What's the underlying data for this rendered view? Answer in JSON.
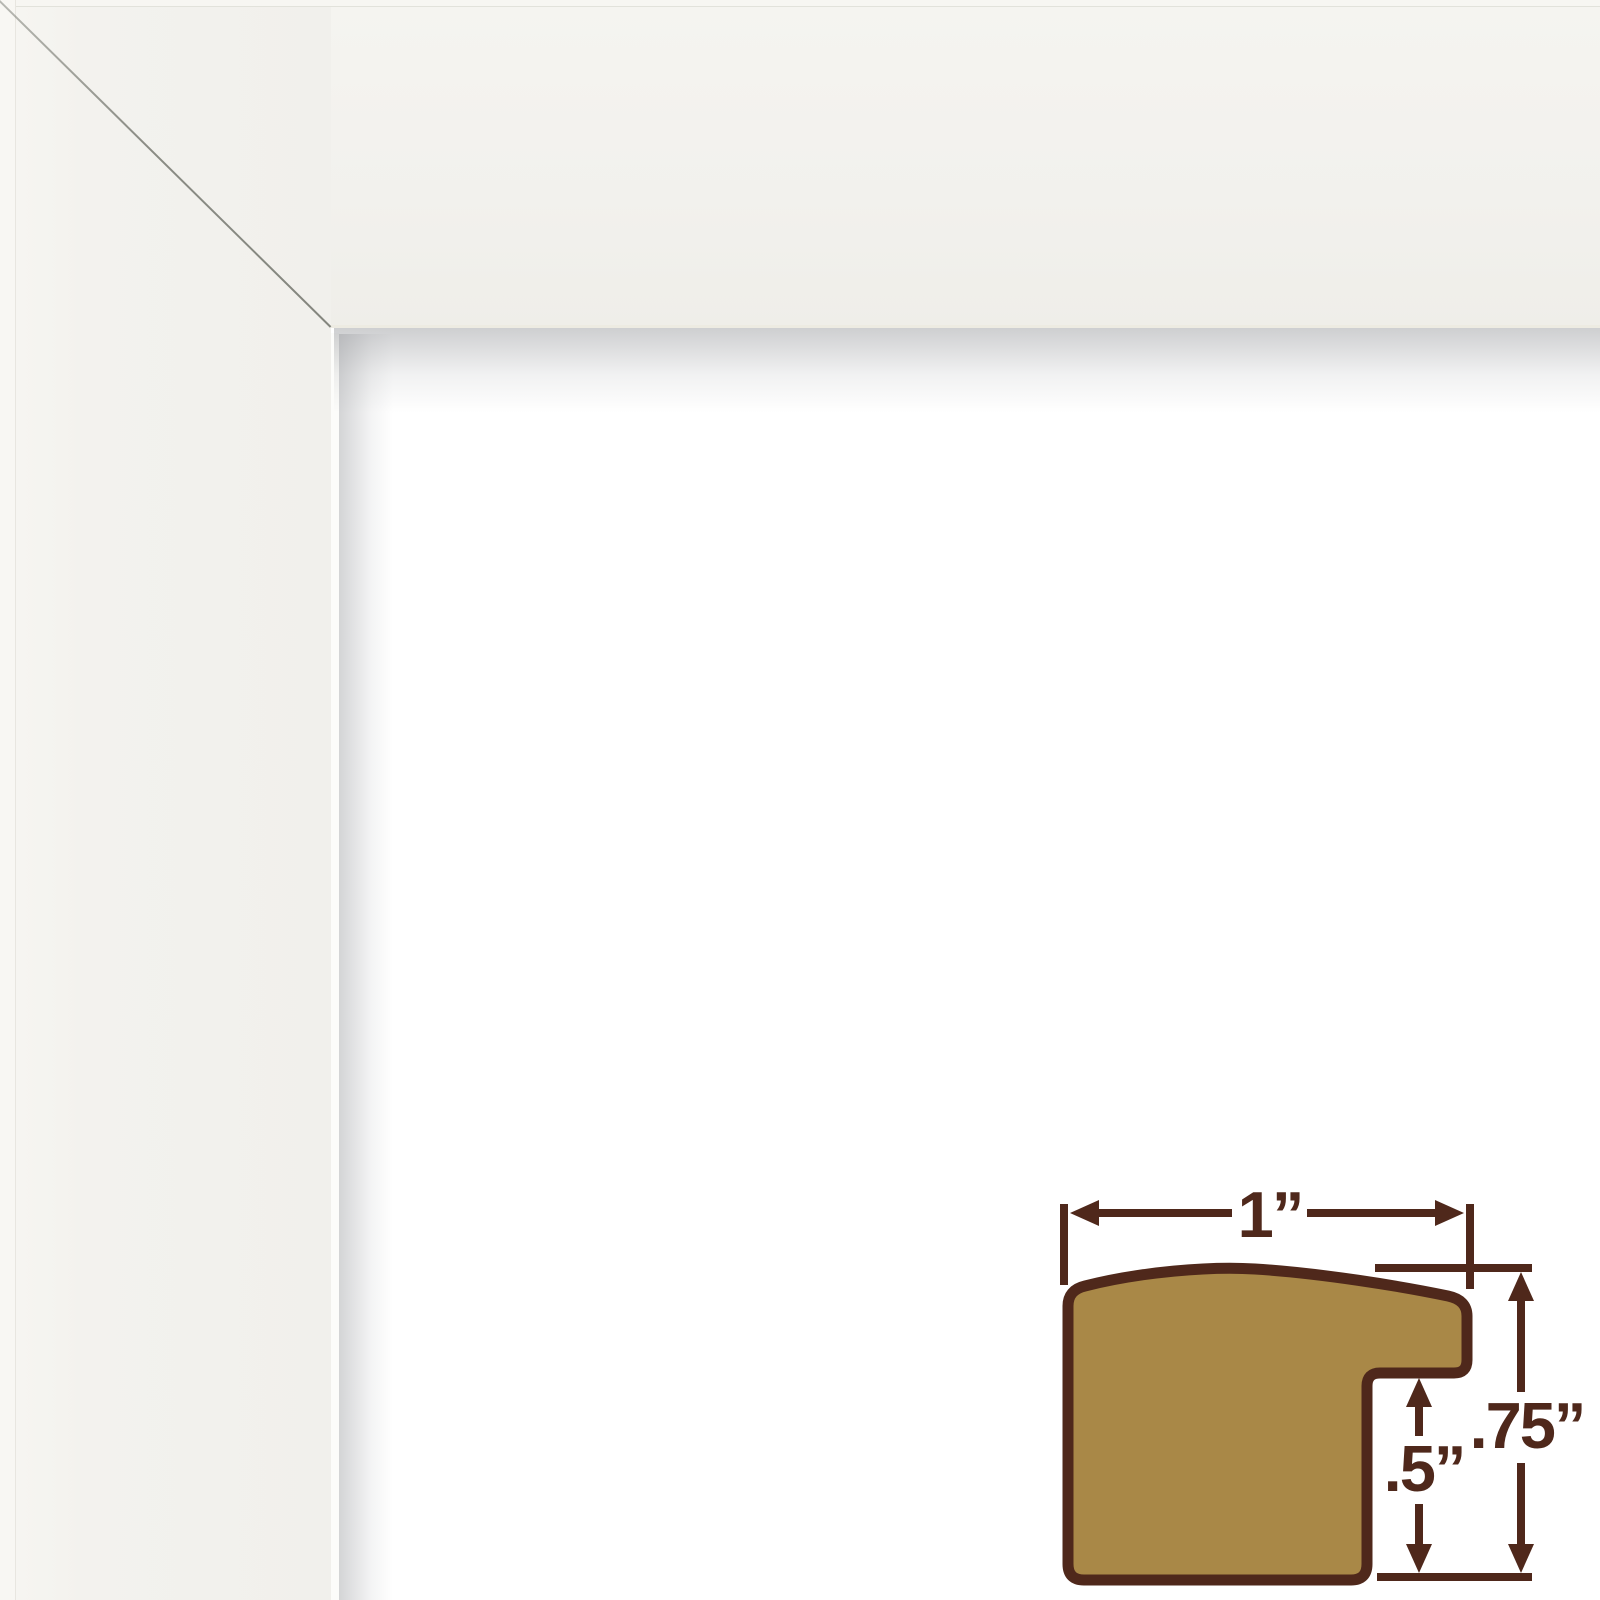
{
  "frame_sample": {
    "face_color": "#F2F1ED",
    "seam_color": "#7A7C72",
    "inner_shadow_color": "#D9D9DB"
  },
  "profile_diagram": {
    "fill_color": "#A98847",
    "outline_color": "#4F281B",
    "labels": {
      "width": "1”",
      "rabbet_depth": ".5”",
      "moulding_height": ".75”"
    }
  }
}
